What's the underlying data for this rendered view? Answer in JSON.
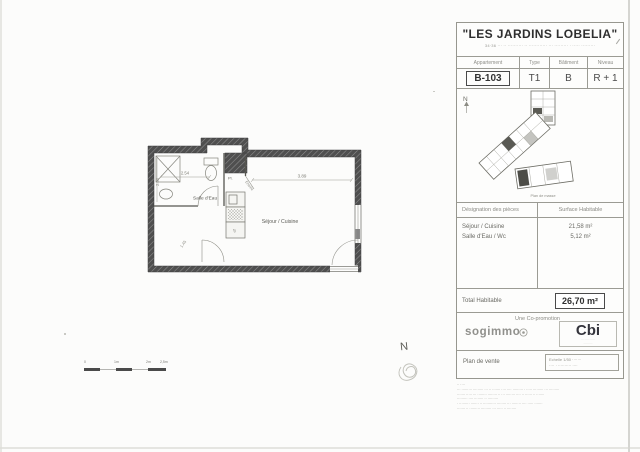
{
  "colors": {
    "paper": "#fcfcfb",
    "wall": "#4e4e4e",
    "ink": "#3c3c3c",
    "muted": "#8a8a8a"
  },
  "title_block": {
    "title": "\"LES JARDINS LOBELIA\"",
    "subtitle": "34·36 ··· ·· ·········· ·· ············ ··· ········· · ····· ·········",
    "apartment_table": {
      "headers": [
        "Appartement",
        "Type",
        "Bâtiment",
        "Niveau"
      ],
      "values": [
        "B-103",
        "T1",
        "B",
        "R + 1"
      ]
    },
    "key_plan": {
      "north_label": "N",
      "caption": "Plan de masse"
    },
    "areas_table": {
      "header_designation": "Désignation des pièces",
      "header_surface": "Surface Habitable",
      "rows": [
        {
          "name": "Séjour / Cuisine",
          "surface": "21,58 m²"
        },
        {
          "name": "Salle d'Eau / Wc",
          "surface": "5,12 m²"
        }
      ],
      "total_label": "Total Habitable",
      "total_value": "26,70 m²"
    },
    "branding": {
      "copromotion": "Une Co-promotion",
      "left_logo": "sogimmo",
      "right_logo": "Cbi",
      "right_logo_sub1": "··· ····· ·····",
      "right_logo_sub2": "·········"
    },
    "footer": {
      "plan_type": "Plan de vente",
      "scale_note": "Echelle 1/50 ·······",
      "date_note": "···· · ·········· ····"
    },
    "legal_lines": [
      "·· ····",
      "··· ········· ········· ··· ·· ······· ···· ···· ········· · ····· ········· ··· ·········",
      "······· ····· ··· ········ ········ ·· ··· ········ ···· ·· ······ ·· ·······",
      "········· ···· ········ ·· ·········",
      "· ········· ······· ·· ··········· ········ ··· ········ ···· ····· ·······",
      "······· ·· ········· ········· ··· ····· ·· ········"
    ]
  },
  "floor_plan": {
    "labels": {
      "bathroom": "Salle d'Eau",
      "living": "Séjour / Cuisine",
      "closet": "Pl.",
      "entry": "Entrée",
      "appliance": "fg"
    },
    "dimensions": {
      "bathroom_width": "2.54",
      "living_width": "3.89",
      "bathroom_depth": "2.50",
      "hall": "1.45"
    }
  },
  "scale_bar": {
    "labels": [
      "0",
      "1m",
      "2m",
      "2,5m"
    ]
  },
  "annotations": {
    "north": "N"
  }
}
